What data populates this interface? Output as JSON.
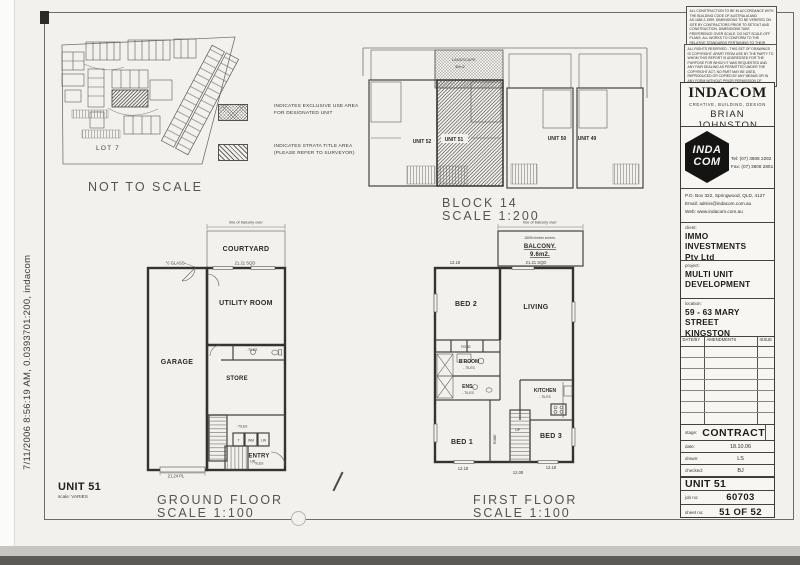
{
  "scan": {
    "print_info": "7/11/2006 8:56:19 AM, 0.0393701:200, indacom"
  },
  "colors": {
    "paper": "#f2f1ed",
    "ink": "#34322f",
    "hatch": "#6f6d69"
  },
  "site_plan": {
    "lot_label": "LOT 7",
    "caption": "NOT TO SCALE"
  },
  "legend": {
    "items": [
      {
        "name": "exclusive-use",
        "line1": "INDICATES EXCLUSIVE USE AREA",
        "line2": "FOR DESIGNATED UNIT"
      },
      {
        "name": "strata-title",
        "line1": "INDICATES STRATA TITLE AREA",
        "line2": "(PLEASE REFER TO SURVEYOR)"
      }
    ]
  },
  "block_plan": {
    "landscape_line1": "LANDSCAPE",
    "landscape_line2": "30m2",
    "units": [
      "UNIT 52",
      "UNIT 51",
      "UNIT 50",
      "UNIT 49"
    ],
    "caption": "BLOCK 14",
    "scale": "SCALE 1:200"
  },
  "ground_floor": {
    "balcony_note": "line of balcony over",
    "courtyard": "COURTYARD",
    "dim_sqd": "21.21 SQD",
    "glass": "½ GLASS",
    "utility": "UTILITY ROOM",
    "garage": "GARAGE",
    "store": "STORE",
    "tiles_wc": "- TILES",
    "tiles_hall": "- TILES",
    "tiles_entry": "- TILES",
    "closet_t": "T",
    "closet_wm": "WM",
    "closet_lin": "LIN",
    "entry": "ENTRY",
    "up": "UP",
    "dim_pl": "21.24 PL",
    "caption": "GROUND FLOOR",
    "scale": "SCALE 1:100"
  },
  "first_floor": {
    "balcony_note": "line of balcony over",
    "screen": "1800h timber screen.",
    "balcony": "BALCONY.",
    "balcony_area": "9.6m2.",
    "dim_sqd": "21.21 SQD",
    "dim_left": "12.18",
    "bed2": "BED 2",
    "living": "LIVING",
    "robe": "ROBE",
    "robe_stair": "ROBE",
    "broom": "B'ROOM",
    "tiles_broom": "- TILES",
    "ens": "ENS.",
    "tiles_ens": "- TILES",
    "kitchen": "KITCHEN",
    "tiles_kitchen": "- TILES",
    "bed1": "BED 1",
    "bed3": "BED 3",
    "up": "UP",
    "dim_b1": "12.18",
    "dim_b2": "12.08",
    "dim_b3": "12.18",
    "caption": "FIRST FLOOR",
    "scale": "SCALE 1:100"
  },
  "sheet_label": {
    "unit": "UNIT 51",
    "scale_label": "scale:",
    "scale_value": "VARIES"
  },
  "title_block": {
    "note1": "ALL CONSTRUCTION TO BE IN ACCORDANCE WITH THE BUILDING CODE OF AUSTRALIA AND AS.1684.2-1999. DIMENSIONS TO BE VERIFIED ON SITE BY CONTRACTORS PRIOR TO SETOUT AND CONSTRUCTION. DIMENSIONS TAKE PREFERENCE OVER SCALE. DO NOT SCALE OFF PLANS. ALL WORKS TO CONFORM TO THE RELATIVE STANDARDS PERTAINING TO THEIR WORKS.",
    "note2": "ALL RIGHTS RESERVED - THIS SET OF DRAWINGS IS COPYRIGHT. APART FROM USE BY THE PARTY TO WHOM THIS REPORT IS ADDRESSED FOR THE PURPOSE FOR WHICH IT WAS REQUESTED AND ANY FAIR DEALING AS PERMITTED UNDER THE COPYRIGHT ACT, NO PART MAY BE USED, REPRODUCED OR COPIED BY ANY MEANS OR IN ANY FORM WITHOUT PRIOR PERMISSION OF INDACOM.",
    "company": "INDACOM",
    "tagline": "CREATIVE, BUILDING, DESIGN",
    "principal": "BRIAN JOHNSTON",
    "registration": "BSA REGO NO 100 38 30",
    "logo_line1": "INDA",
    "logo_line2": "COM",
    "tel": "Tel: (07) 3808 2292",
    "fax": "Fax: (07) 3808 2851",
    "address": "P.O. Box 322, Springwood, QLD, 4127",
    "email": "Email: admin@indacom.com.au",
    "web": "Web: www.indacom.com.au",
    "client_label": "client:",
    "client_line1": "IMMO INVESTMENTS",
    "client_line2": "Pty Ltd",
    "project_label": "project:",
    "project_line1": "MULTI UNIT",
    "project_line2": "DEVELOPMENT",
    "location_label": "location:",
    "location_line1": "59 - 63 MARY STREET",
    "location_line2": "KINGSTON",
    "amendments": {
      "col1": "DATE/BY",
      "col2": "AMENDMENTS",
      "col3": "ISSUE"
    },
    "stage_label": "stage:",
    "stage_value": "CONTRACT",
    "date_label": "date:",
    "date_value": "18.10.06",
    "drawn_label": "drawn:",
    "drawn_value": "LS",
    "checked_label": "checked:",
    "checked_value": "BJ",
    "unit": "UNIT 51",
    "job_label": "job no:",
    "job_value": "60703",
    "sheet_label": "sheet no:",
    "sheet_value": "51 OF 52"
  }
}
